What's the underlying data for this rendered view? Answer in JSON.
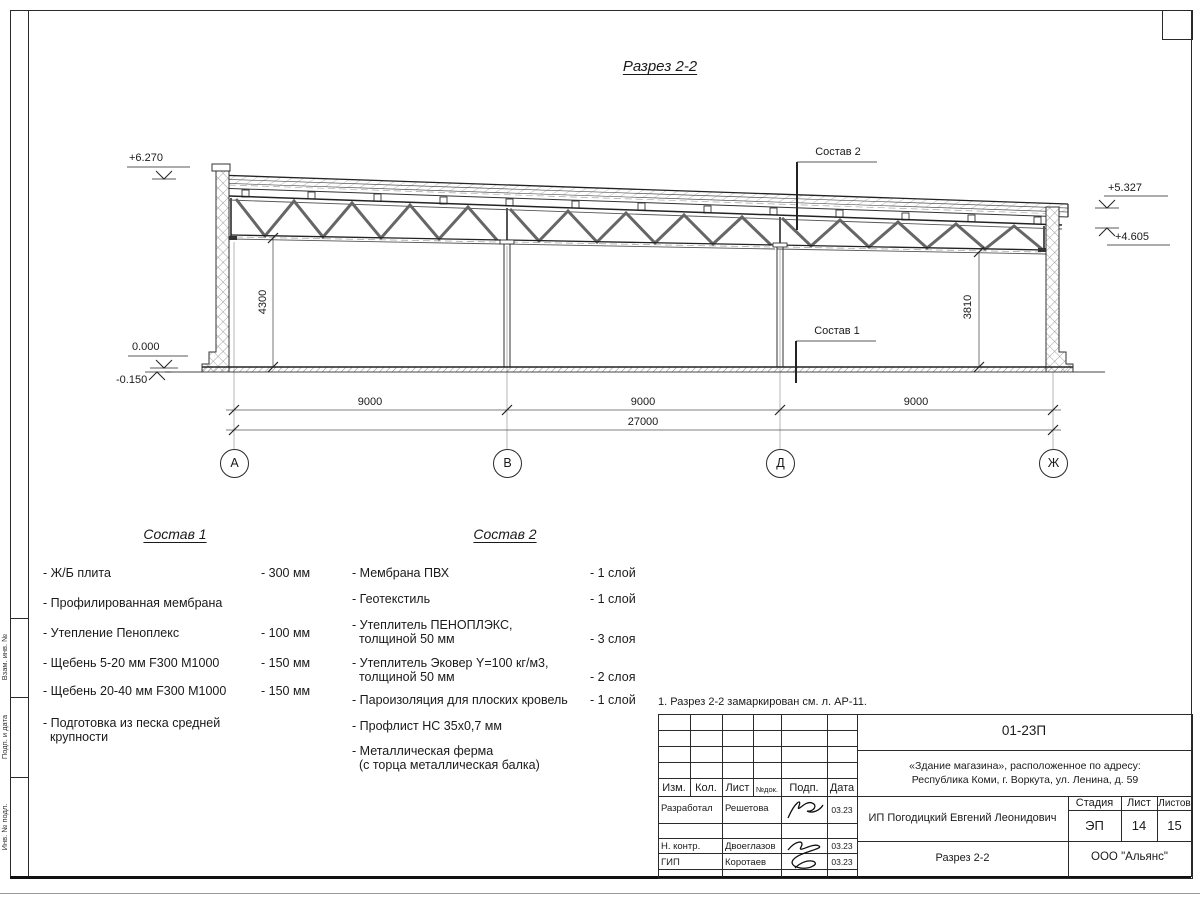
{
  "sheet": {
    "title": "Разрез 2-2",
    "note": "1. Разрез 2-2 замаркирован см. л. АР-11."
  },
  "drawing": {
    "elevations": {
      "top_left": "+6.270",
      "top_right": "+5.327",
      "right_lower": "+4.605",
      "floor": "0.000",
      "below_floor": "-0.150"
    },
    "leaders": {
      "sostav1": "Состав 1",
      "sostav2": "Состав 2"
    },
    "dims": {
      "left_height": "4300",
      "right_height": "3810",
      "spans": [
        "9000",
        "9000",
        "9000"
      ],
      "total": "27000"
    },
    "axes": [
      "А",
      "В",
      "Д",
      "Ж"
    ]
  },
  "sostav1": {
    "heading": "Состав 1",
    "items": [
      {
        "name": "- Ж/Б плита",
        "value": "- 300 мм"
      },
      {
        "name": "- Профилированная мембрана",
        "value": ""
      },
      {
        "name": "- Утепление Пеноплекс",
        "value": "- 100 мм"
      },
      {
        "name": "-  Щебень 5-20 мм F300 М1000",
        "value": "- 150 мм"
      },
      {
        "name": "-  Щебень 20-40 мм F300 М1000",
        "value": "- 150 мм"
      },
      {
        "name": "- Подготовка из песка средней\n  крупности",
        "value": ""
      }
    ]
  },
  "sostav2": {
    "heading": "Состав 2",
    "items": [
      {
        "name": "- Мембрана ПВХ",
        "value": "- 1 слой"
      },
      {
        "name": "- Геотекстиль",
        "value": "- 1 слой"
      },
      {
        "name": "- Утеплитель ПЕНОПЛЭКС,\n  толщиной 50 мм",
        "value": "- 3 слоя"
      },
      {
        "name": "- Утеплитель Эковер Y=100 кг/м3,\n  толщиной 50 мм",
        "value": "- 2 слоя"
      },
      {
        "name": "- Пароизоляция для плоских кровель",
        "value": "- 1 слой"
      },
      {
        "name": "- Профлист НС 35х0,7 мм",
        "value": ""
      },
      {
        "name": "- Металлическая ферма\n  (с торца металлическая балка)",
        "value": ""
      }
    ]
  },
  "titleblock": {
    "doc_number": "01-23П",
    "object": "«Здание магазина», расположенное по адресу:\nРеспублика Коми, г. Воркута, ул. Ленина, д. 59",
    "header_cells": [
      "Изм.",
      "Кол.",
      "Лист",
      "№док.",
      "Подп.",
      "Дата"
    ],
    "rows": [
      {
        "role": "Разработал",
        "name": "Решетова",
        "date": "03.23"
      },
      {
        "role": "",
        "name": "",
        "date": ""
      },
      {
        "role": "Н. контр.",
        "name": "Двоеглазов",
        "date": "03.23"
      },
      {
        "role": "ГИП",
        "name": "Коротаев",
        "date": "03.23"
      }
    ],
    "client": "ИП Погодицкий Евгений Леонидович",
    "stage_label": "Стадия",
    "sheet_label": "Лист",
    "sheets_label": "Листов",
    "stage": "ЭП",
    "sheet_no": "14",
    "sheets_total": "15",
    "drawing_name": "Разрез 2-2",
    "company": "ООО \"Альянс\""
  },
  "frame": {
    "side_labels": [
      "Взам. инв. №",
      "Подп. и дата",
      "Инв. № подл."
    ]
  }
}
